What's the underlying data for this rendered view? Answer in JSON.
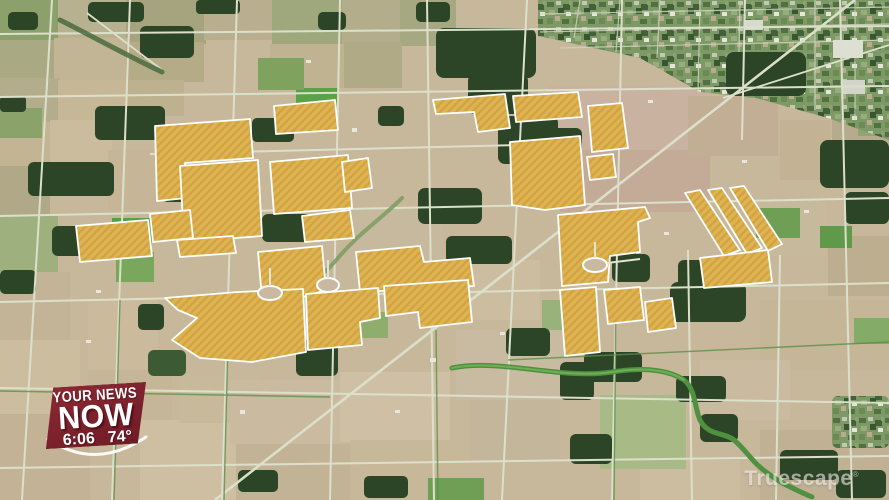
{
  "overlay": {
    "station_logo": {
      "line1": "YOUR NEWS",
      "line2": "NOW",
      "time": "6:06",
      "temperature": "74°",
      "badge_color": "#7d212c",
      "text_color": "#ffffff"
    },
    "watermark": {
      "text": "Truescape",
      "mark": "®"
    }
  },
  "map": {
    "description": "Aerial perspective rendering of farmland with proposed solar project parcels highlighted in striped yellow",
    "colors": {
      "farmland_tan": "#c7b79b",
      "farmland_light": "#cdbfa3",
      "farmland_pink": "#c9b2a0",
      "field_green": "#6f9e55",
      "forest_dark": "#2c4526",
      "road_light": "#dce0cb",
      "hedge_green": "#5d8f4a",
      "town_base": "#7d9a66",
      "creek_green": "#4f9140",
      "solar_fill": "#e0b351",
      "solar_stripe": "#c39736",
      "solar_border": "#ffffff"
    }
  }
}
